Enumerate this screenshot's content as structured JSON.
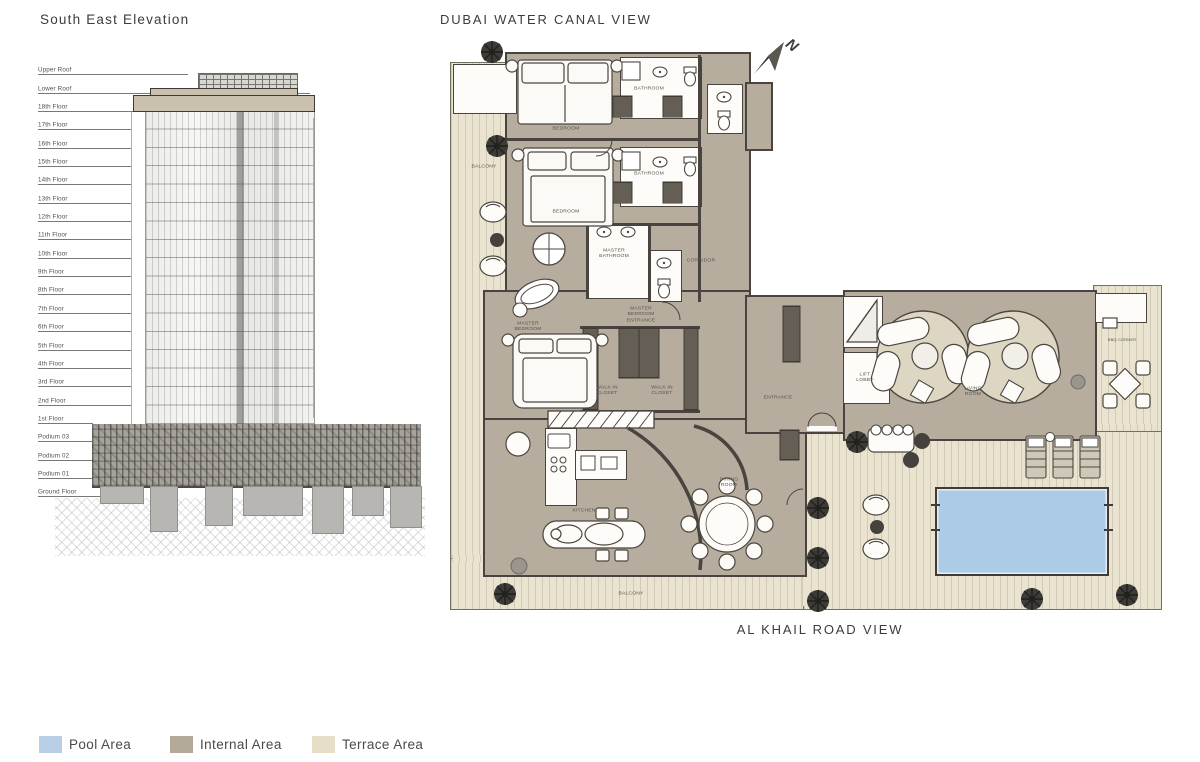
{
  "elevation": {
    "title": "South East Elevation",
    "floors": [
      "Upper Roof",
      "Lower Roof",
      "18th Floor",
      "17th Floor",
      "16th Floor",
      "15th Floor",
      "14th Floor",
      "13th Floor",
      "12th Floor",
      "11th Floor",
      "10th Floor",
      "9th Floor",
      "8th Floor",
      "7th Floor",
      "6th Floor",
      "5th Floor",
      "4th Floor",
      "3rd Floor",
      "2nd Floor",
      "1st Floor",
      "Podium 03",
      "Podium 02",
      "Podium 01",
      "Ground Floor"
    ]
  },
  "floorplan": {
    "top_view_label": "DUBAI WATER CANAL VIEW",
    "bottom_view_label": "AL KHAIL ROAD VIEW",
    "north_label": "N",
    "rooms": {
      "balcony_left": "BALCONY",
      "bedroom_1": "BEDROOM",
      "bathroom_1": "BATHROOM",
      "bedroom_2": "BEDROOM",
      "bathroom_2": "BATHROOM",
      "master_bathroom": "MASTER BATHROOM",
      "master_bedroom": "MASTER BEDROOM",
      "master_bedroom_entrance": "MASTER BEDROOM ENTRANCE",
      "walk_in_closet_1": "WALK IN CLOSET",
      "walk_in_closet_2": "WALK IN CLOSET",
      "corridor": "CORRIDOR",
      "entrance": "ENTRANCE",
      "lift_lobby": "LIFT LOBBY",
      "living_room": "LIVING ROOM",
      "kitchen": "KITCHEN",
      "dining_room": "DINING ROOM",
      "bbq_corner": "BBQ CORNER",
      "balcony_bottom": "BALCONY"
    }
  },
  "legend": {
    "items": [
      {
        "label": "Pool Area",
        "color": "#b9cfe6"
      },
      {
        "label": "Internal Area",
        "color": "#b2a998"
      },
      {
        "label": "Terrace Area",
        "color": "#e6dfc8"
      }
    ]
  },
  "colors": {
    "pool": "#accbe7",
    "internal": "#b6ad9e",
    "terrace": "#e9e3d0",
    "wall": "#49443f"
  }
}
